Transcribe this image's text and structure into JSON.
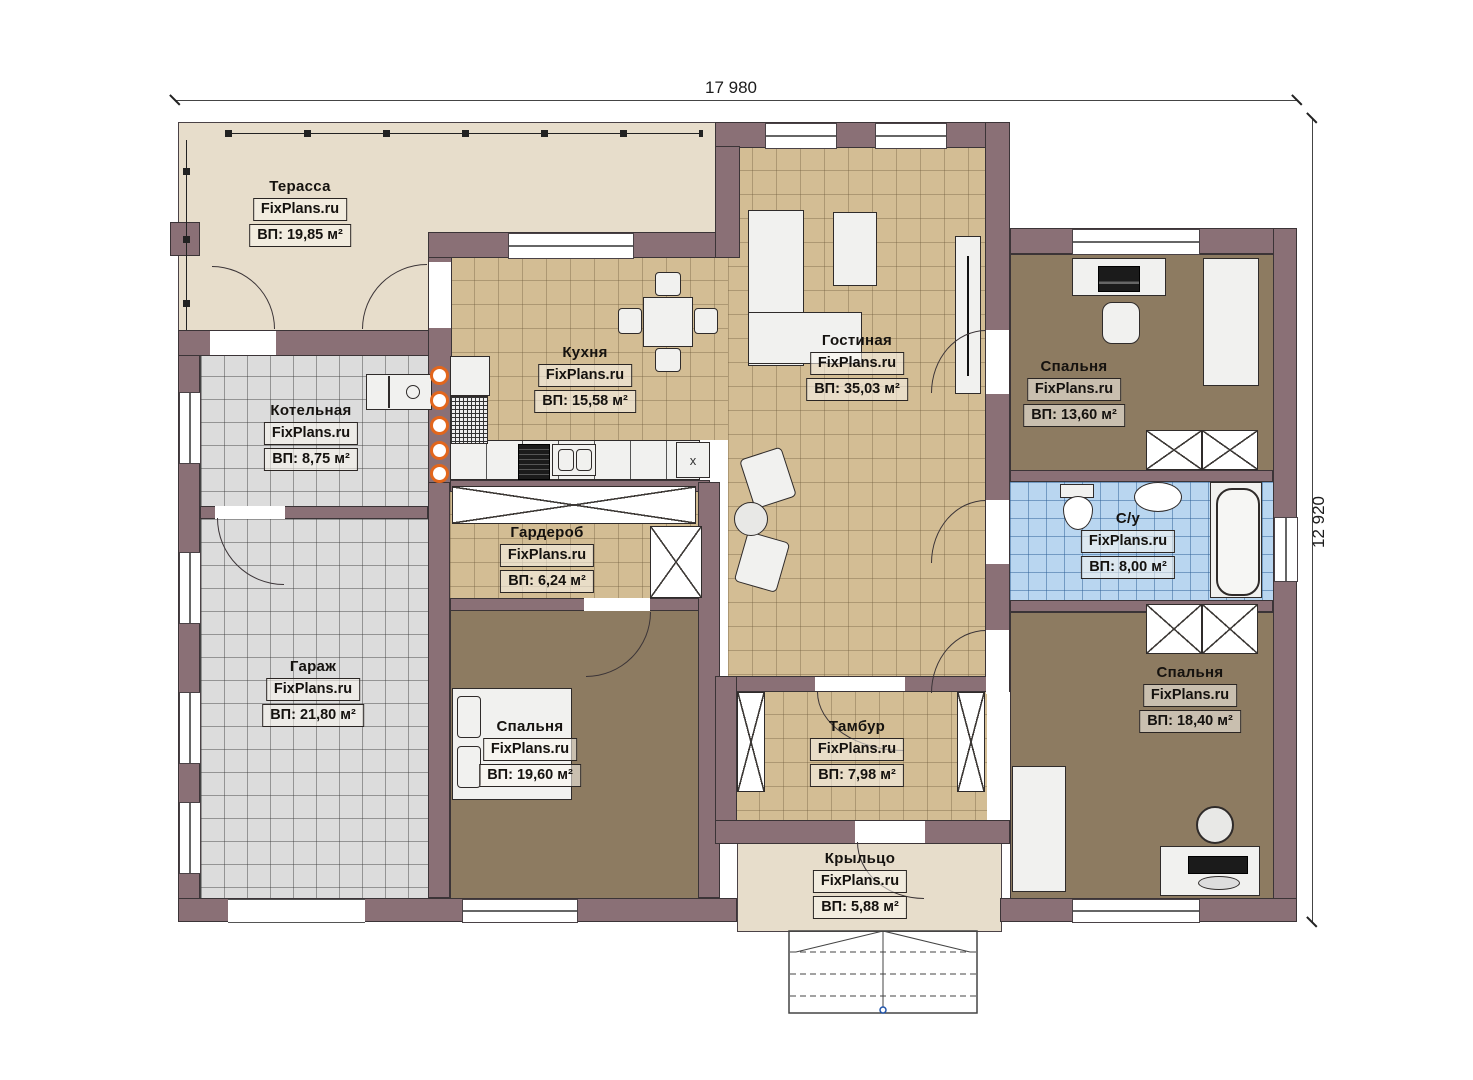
{
  "dimensions": {
    "top": "17 980",
    "right": "12 920"
  },
  "watermark": "FixPlans.ru",
  "rooms": {
    "terrace": {
      "name": "Терасса",
      "area": "ВП: 19,85 м²"
    },
    "boiler": {
      "name": "Котельная",
      "area": "ВП: 8,75 м²"
    },
    "garage": {
      "name": "Гараж",
      "area": "ВП: 21,80 м²"
    },
    "kitchen": {
      "name": "Кухня",
      "area": "ВП: 15,58 м²"
    },
    "living": {
      "name": "Гостиная",
      "area": "ВП: 35,03 м²"
    },
    "wardrobe": {
      "name": "Гардероб",
      "area": "ВП: 6,24 м²"
    },
    "bedroom_left": {
      "name": "Спальня",
      "area": "ВП: 19,60 м²"
    },
    "bedroom_top_right": {
      "name": "Спальня",
      "area": "ВП: 13,60 м²"
    },
    "bathroom": {
      "name": "С/у",
      "area": "ВП: 8,00 м²"
    },
    "bedroom_bottom_right": {
      "name": "Спальня",
      "area": "ВП: 18,40 м²"
    },
    "vestibule": {
      "name": "Тамбур",
      "area": "ВП: 7,98 м²"
    },
    "porch": {
      "name": "Крыльцо",
      "area": "ВП: 5,88 м²"
    }
  },
  "marks": {
    "counter_x": "x"
  },
  "colors": {
    "wall": "#8a7076",
    "wall_outline": "#3b3437",
    "floor_tan": "#d3bd94",
    "floor_gray": "#dcdcdc",
    "floor_blue": "#b9d6f0",
    "floor_brown": "#8d7b61",
    "floor_beige": "#e7ddcb",
    "radiator_orange": "#e2661c"
  }
}
